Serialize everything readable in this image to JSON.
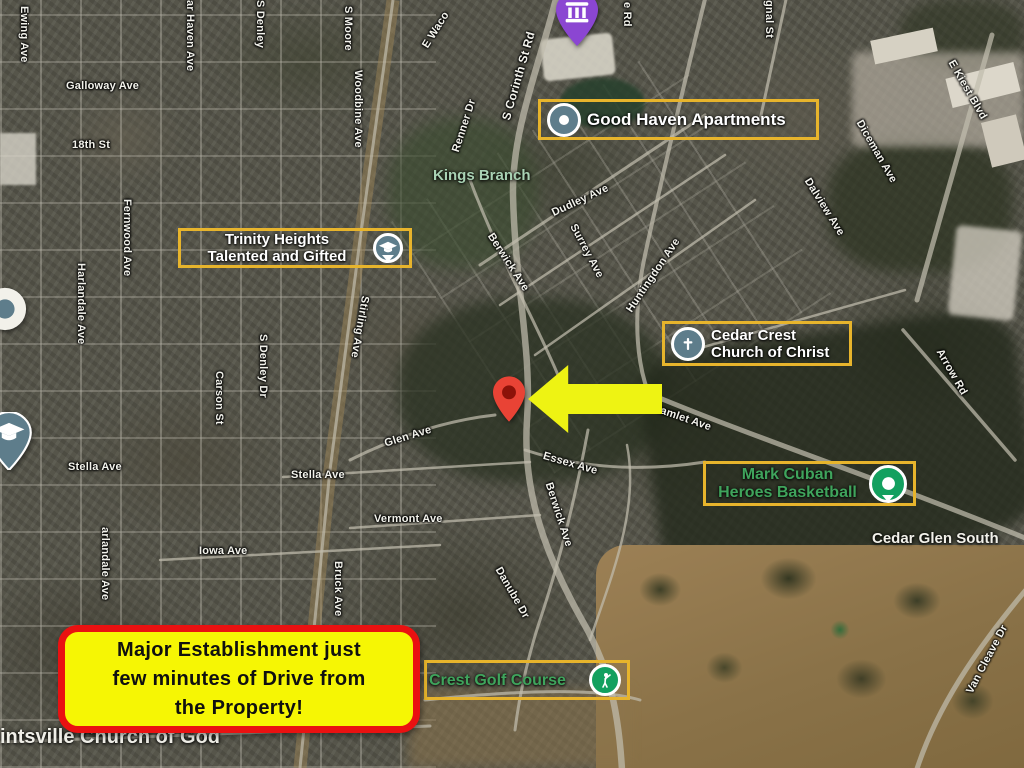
{
  "map": {
    "callout": {
      "line1": "Major Establishment just",
      "line2": "few minutes of Drive from",
      "line3": "the Property!"
    },
    "pois": {
      "good_haven": {
        "label": "Good Haven Apartments"
      },
      "trinity": {
        "line1": "Trinity Heights",
        "line2": "Talented and Gifted"
      },
      "cedar_crest": {
        "line1": "Cedar Crest",
        "line2": "Church of Christ"
      },
      "mark_cuban": {
        "line1": "Mark Cuban",
        "line2": "Heroes Basketball"
      },
      "golf_course": {
        "label": "Crest Golf Course"
      }
    },
    "areas": {
      "kings_branch": "Kings Branch",
      "cedar_glen_south": "Cedar Glen South",
      "church_of_god": "intsville Church of God"
    },
    "streets": [
      {
        "text": "Ewing Ave"
      },
      {
        "text": "Galloway Ave"
      },
      {
        "text": "18th St"
      },
      {
        "text": "ar Haven Ave"
      },
      {
        "text": "S Denley"
      },
      {
        "text": "S Moore"
      },
      {
        "text": "Woodbine Ave"
      },
      {
        "text": "E Waco"
      },
      {
        "text": "S Corinth St Rd"
      },
      {
        "text": "Renner Dr"
      },
      {
        "text": "e Rd"
      },
      {
        "text": "gnal St"
      },
      {
        "text": "E Kiest Blvd"
      },
      {
        "text": "Diceman Ave"
      },
      {
        "text": "Dalview Ave"
      },
      {
        "text": "Dudley Ave"
      },
      {
        "text": "Berwick Ave"
      },
      {
        "text": "Surrey Ave"
      },
      {
        "text": "Huntingdon Ave"
      },
      {
        "text": "Fernwood Ave"
      },
      {
        "text": "Harlandale Ave"
      },
      {
        "text": "Stirling Ave"
      },
      {
        "text": "Carson St"
      },
      {
        "text": "S Denley Dr"
      },
      {
        "text": "Glen Ave"
      },
      {
        "text": "Stella Ave"
      },
      {
        "text": "Stella Ave"
      },
      {
        "text": "Essex Ave"
      },
      {
        "text": "Hamlet Ave"
      },
      {
        "text": "Arrow Rd"
      },
      {
        "text": "Berwick Ave"
      },
      {
        "text": "Vermont Ave"
      },
      {
        "text": "Iowa Ave"
      },
      {
        "text": "Danube Dr"
      },
      {
        "text": "Bruck Ave"
      },
      {
        "text": "arlandale Ave"
      },
      {
        "text": "Van Cleave Dr"
      }
    ],
    "markers": {
      "property_pin": "red-map-pin",
      "direction_arrow": "yellow-left-arrow",
      "worship_pin": "purple-temple-pin",
      "school_pin": "graduation-cap-pin",
      "unknown_pin": "white-circle-pin"
    },
    "icons": {
      "apartments": "place-dot",
      "school": "graduation-cap",
      "church": "cross",
      "basketball": "green-place-dot",
      "golf": "golfer"
    },
    "colors": {
      "poi_border": "#e7b42c",
      "callout_border": "#ea1111",
      "callout_bg": "#f6f604",
      "arrow_yellow": "#eef313",
      "pin_red": "#e94335",
      "poi_icon_slate": "#5e7d8b",
      "poi_icon_green": "#13a05f",
      "poi_text_green": "#3fa45c",
      "street_text": "#f3f3ec",
      "area_text_green": "#a9d2b4"
    }
  }
}
